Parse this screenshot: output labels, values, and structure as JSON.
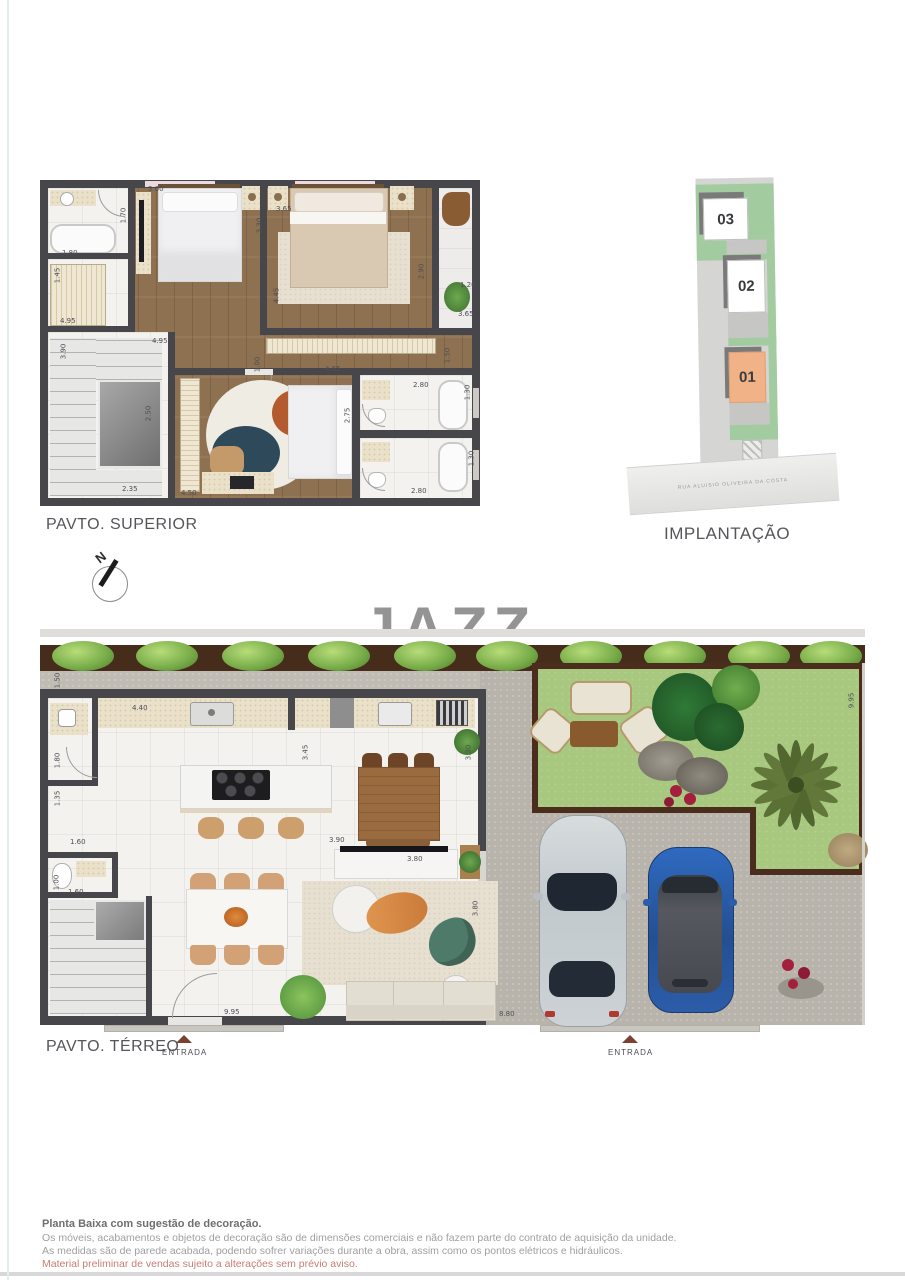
{
  "watermark": "JAZZ",
  "superior": {
    "title": "PAVTO. SUPERIOR",
    "dims": [
      {
        "t": "3.00",
        "x": 108,
        "y": 6
      },
      {
        "t": "3.65",
        "x": 236,
        "y": 26
      },
      {
        "t": "1.70",
        "x": 76,
        "y": 32,
        "r": 1
      },
      {
        "t": "1.80",
        "x": 22,
        "y": 70
      },
      {
        "t": "3.30",
        "x": 212,
        "y": 42,
        "r": 1
      },
      {
        "t": "1.45",
        "x": 10,
        "y": 92,
        "r": 1
      },
      {
        "t": "2.90",
        "x": 374,
        "y": 88,
        "r": 1
      },
      {
        "t": "1.20",
        "x": 420,
        "y": 102
      },
      {
        "t": "4.95",
        "x": 20,
        "y": 138
      },
      {
        "t": "3.65",
        "x": 418,
        "y": 131
      },
      {
        "t": "4.95",
        "x": 112,
        "y": 158
      },
      {
        "t": "4.45",
        "x": 229,
        "y": 112,
        "r": 1
      },
      {
        "t": "1.00",
        "x": 210,
        "y": 181,
        "r": 1
      },
      {
        "t": "3.90",
        "x": 16,
        "y": 168,
        "r": 1
      },
      {
        "t": "1.50",
        "x": 400,
        "y": 172,
        "r": 1
      },
      {
        "t": "4.65",
        "x": 285,
        "y": 186
      },
      {
        "t": "2.80",
        "x": 373,
        "y": 202
      },
      {
        "t": "1.30",
        "x": 420,
        "y": 209,
        "r": 1
      },
      {
        "t": "2.75",
        "x": 300,
        "y": 232,
        "r": 1
      },
      {
        "t": "2.50",
        "x": 101,
        "y": 230,
        "r": 1
      },
      {
        "t": "1.30",
        "x": 424,
        "y": 275,
        "r": 1
      },
      {
        "t": "2.80",
        "x": 371,
        "y": 308
      },
      {
        "t": "2.35",
        "x": 82,
        "y": 306
      },
      {
        "t": "4.50",
        "x": 141,
        "y": 310
      }
    ]
  },
  "implantacao": {
    "title": "IMPLANTAÇÃO",
    "units": [
      {
        "label": "03"
      },
      {
        "label": "02"
      },
      {
        "label": "01"
      }
    ],
    "street": "RUA ALUISIO OLIVEIRA DA COSTA"
  },
  "compass": {
    "north_label": "N"
  },
  "terreo": {
    "title": "PAVTO. TÉRREO",
    "entrance_label": "ENTRADA",
    "entrance2_label": "ENTRADA",
    "dims": [
      {
        "t": "1.50",
        "x": 10,
        "y": 40,
        "r": 1
      },
      {
        "t": "4.40",
        "x": 92,
        "y": 68
      },
      {
        "t": "1.80",
        "x": 10,
        "y": 120,
        "r": 1
      },
      {
        "t": "1.35",
        "x": 10,
        "y": 158,
        "r": 1
      },
      {
        "t": "1.60",
        "x": 30,
        "y": 202
      },
      {
        "t": "3.45",
        "x": 258,
        "y": 112,
        "r": 1
      },
      {
        "t": "3.30",
        "x": 421,
        "y": 112,
        "r": 1
      },
      {
        "t": "3.90",
        "x": 289,
        "y": 200
      },
      {
        "t": "3.80",
        "x": 367,
        "y": 219
      },
      {
        "t": "3.80",
        "x": 428,
        "y": 268,
        "r": 1
      },
      {
        "t": "1.00",
        "x": 9,
        "y": 242,
        "r": 1
      },
      {
        "t": "1.60",
        "x": 28,
        "y": 252
      },
      {
        "t": "9.95",
        "x": 184,
        "y": 372
      },
      {
        "t": "8.80",
        "x": 459,
        "y": 374
      },
      {
        "t": "9.95",
        "x": 804,
        "y": 60,
        "r": 1
      }
    ]
  },
  "disclaimer": {
    "line1": "Planta Baixa com sugestão de decoração.",
    "line2": "Os móveis, acabamentos e objetos de decoração são de dimensões comerciais e não fazem parte do contrato de aquisição da unidade.",
    "line3": "As medidas são de parede acabada, podendo sofrer variações durante a obra, assim como os pontos elétricos e hidráulicos.",
    "line4": "Material preliminar de vendas sujeito a alterações sem prévio aviso."
  },
  "colors": {
    "entrada_arrow": "#7c4035",
    "unit01_bg": "#f2b287",
    "watermark_gray": "#949494",
    "disclaimer_warning": "#c57f72",
    "wall": "#47474b"
  }
}
